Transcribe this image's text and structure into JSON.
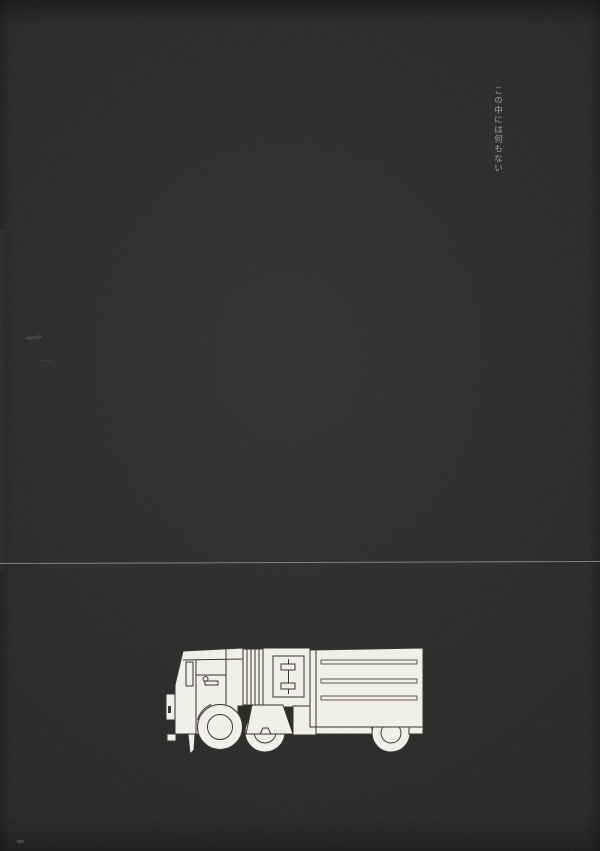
{
  "page": {
    "caption": "この中には何もない"
  },
  "illustration": {
    "name": "truck-line-illustration",
    "description_label": "truck"
  },
  "colors": {
    "background": "#212020",
    "divider_line": "#8f8f8b",
    "caption_text": "#adada7",
    "truck_fill": "#f0efe9",
    "truck_stroke": "#3a3530"
  }
}
